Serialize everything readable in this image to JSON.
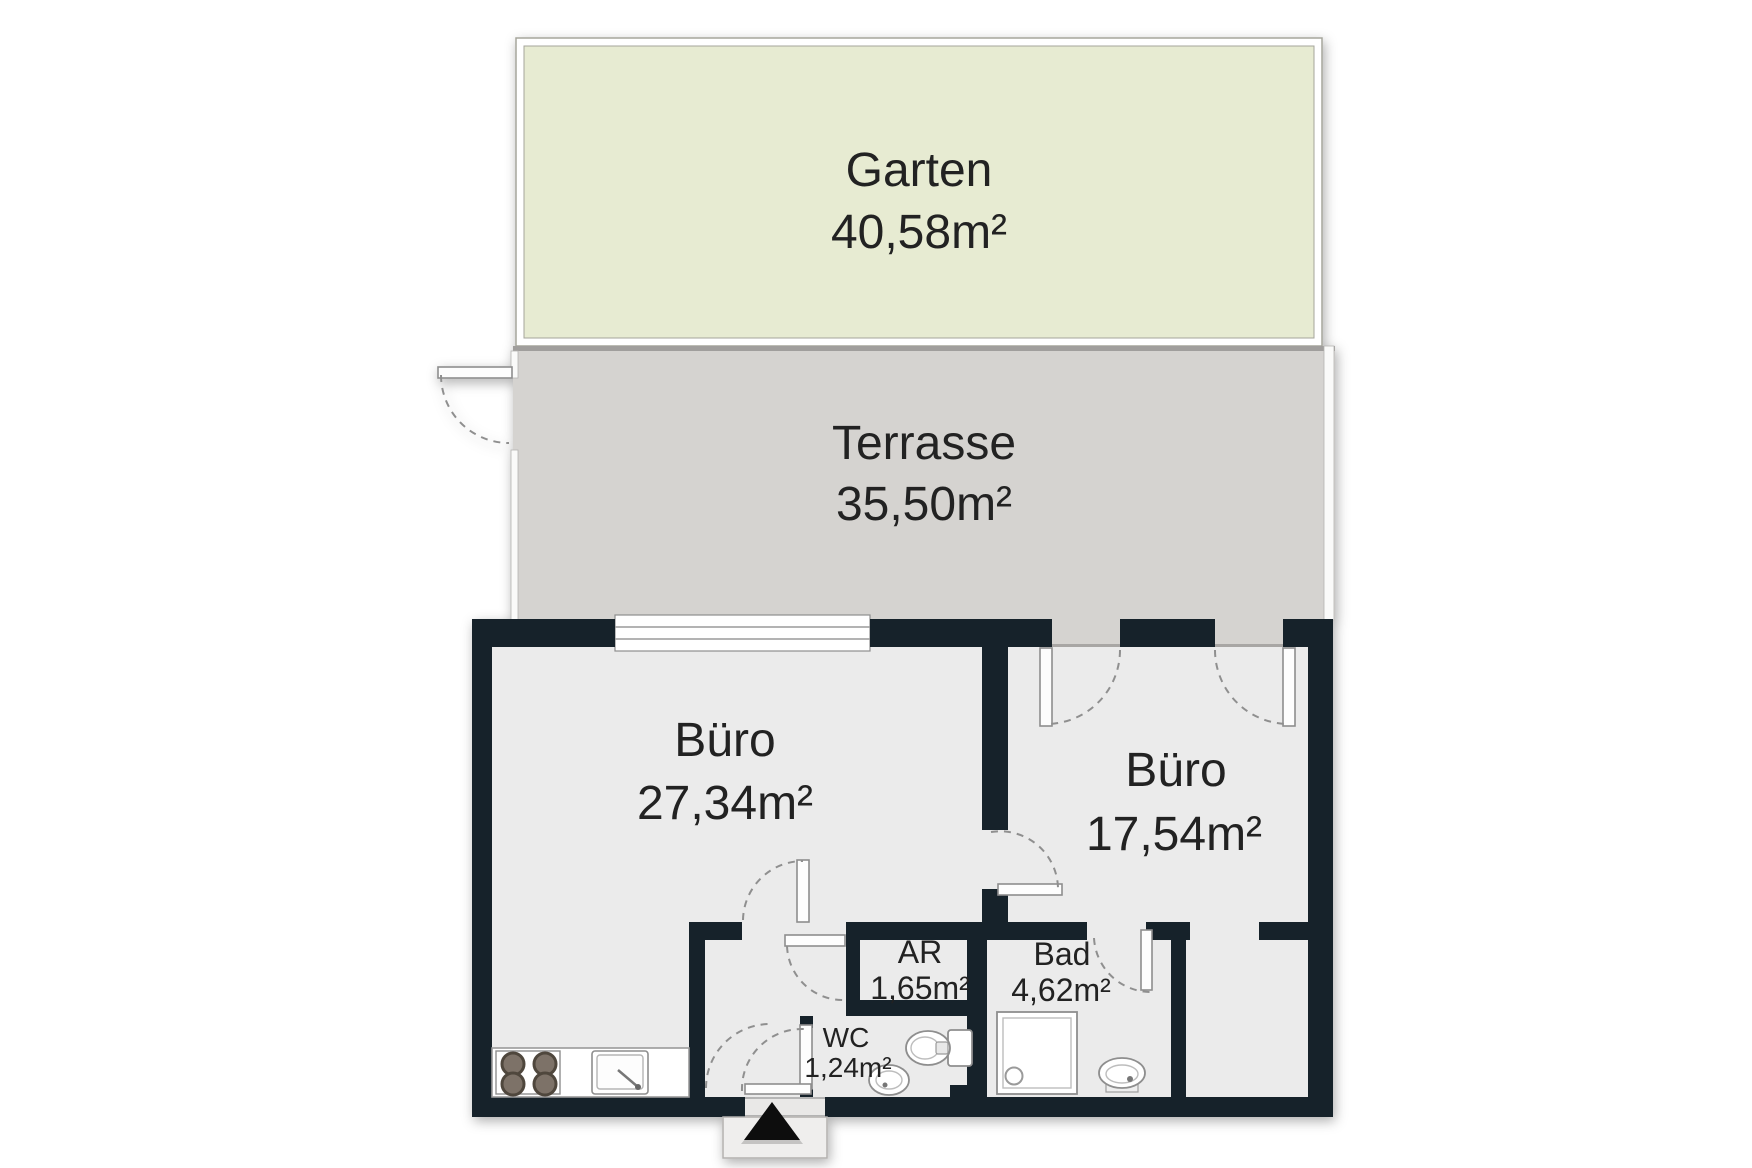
{
  "rooms": {
    "garten": {
      "name": "Garten",
      "area": "40,58m²"
    },
    "terrasse": {
      "name": "Terrasse",
      "area": "35,50m²"
    },
    "buero_links": {
      "name": "Büro",
      "area": "27,34m²"
    },
    "buero_rechts": {
      "name": "Büro",
      "area": "17,54m²"
    },
    "abstellraum": {
      "name": "AR",
      "area": "1,65m²"
    },
    "bad": {
      "name": "Bad",
      "area": "4,62m²"
    },
    "wc": {
      "name": "WC",
      "area": "1,24m²"
    }
  },
  "colors": {
    "wall": "#15202c",
    "floor": "#ebebeb",
    "terrace": "#d5d3d0",
    "garden": "#e7ebd2",
    "label": "#222222"
  }
}
